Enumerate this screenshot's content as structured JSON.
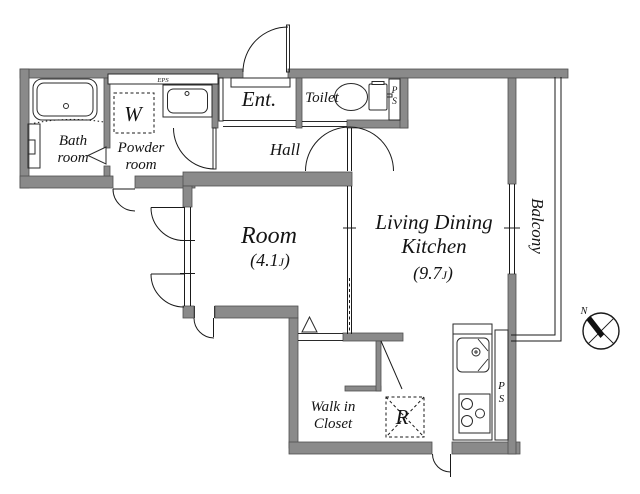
{
  "floorplan": {
    "rooms": {
      "bath": {
        "line1": "Bath",
        "line2": "room"
      },
      "powder": {
        "line1": "Powder",
        "line2": "room"
      },
      "washer": {
        "label": "W"
      },
      "eps": {
        "label": "EPS"
      },
      "entrance": {
        "label": "Ent."
      },
      "toilet": {
        "label": "Toilet"
      },
      "ps_top": {
        "p": "P",
        "s": "S"
      },
      "hall": {
        "label": "Hall"
      },
      "room": {
        "label": "Room",
        "size_prefix": "(4.1",
        "size_j": "J",
        "size_suffix": ")"
      },
      "ldk": {
        "line1": "Living Dining",
        "line2": "Kitchen",
        "size_prefix": "(9.7",
        "size_j": "J",
        "size_suffix": ")"
      },
      "balcony": {
        "label": "Balcony"
      },
      "wic": {
        "line1": "Walk in",
        "line2": "Closet"
      },
      "fridge": {
        "label": "R"
      },
      "ps_kitchen": {
        "p": "P",
        "s": "S"
      }
    },
    "compass": {
      "north": "N"
    },
    "colors": {
      "wall": "#8a8a8a",
      "wall_edge": "#4f4f4f",
      "line": "#1a1a1a",
      "background": "#ffffff"
    }
  }
}
